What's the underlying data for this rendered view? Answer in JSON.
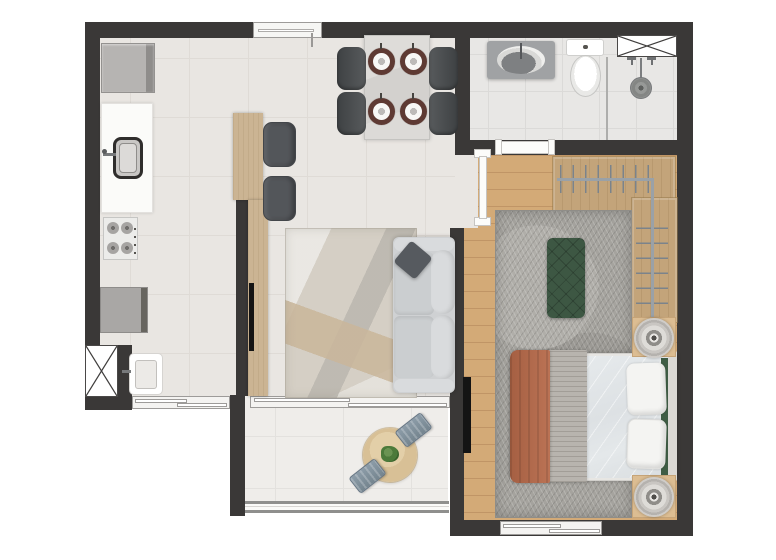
{
  "meta": {
    "type": "apartment-floor-plan",
    "view": "top-down-3d-render",
    "canvas_width": 776,
    "canvas_height": 560,
    "visible_text": "none"
  },
  "colors": {
    "wall": "#3a3837",
    "floor-main": "#e9e6e2",
    "tile-line": "#dfdbd6",
    "floor-bath": "#e8e7e5",
    "floor-balcony": "#efedea",
    "wood-floor": "#d3aa77",
    "plank-line": "#c09566",
    "wood-closet": "#c3a47a",
    "wood-island": "#cbb493",
    "rug-living": "#d5cfc5",
    "rug-bedroom": "#a5a39e",
    "sofa": "#cfd1d3",
    "sofa-light": "#d9dbdd",
    "pillow-dark": "#565a5f",
    "chair-dark": "#4b4e50",
    "stool": "#53565a",
    "table-marble": "#dad8d5",
    "charger": "#5e3a33",
    "bench-green": "#3d5743",
    "duvet": "#dfe3e6",
    "blanket": "#b2694c",
    "throw": "#b8b4ae",
    "headboard-green": "#3f5d45",
    "nightstand": "#dcbd92",
    "counter-white": "#fbfbf9",
    "appliance": "#b0aeac",
    "washer": "#a9a7a5",
    "vanity": "#a0a2a4",
    "fixture-white": "#f8f8f6",
    "drain": "#8a8c8e",
    "rod": "#9aa1a7",
    "hanger": "#7b838b",
    "balcony-table": "#d8c096",
    "balcony-chair": "#7f8f9b",
    "plant": "#4c7a3a",
    "railing": "#8f8f8d",
    "window-white": "#f4f3f1",
    "tv": "#141414",
    "door-white": "#fcfcfa"
  },
  "rooms": [
    {
      "id": "kitchen",
      "items": [
        "refrigerator",
        "counter-with-sink",
        "cooktop-4-burners",
        "island-counter",
        "bar-stool",
        "bar-stool"
      ]
    },
    {
      "id": "service-area",
      "items": [
        "washing-machine",
        "laundry-tank",
        "ventilation-shaft",
        "window"
      ]
    },
    {
      "id": "dining",
      "items": [
        "dining-table",
        "place-setting-x4",
        "dining-chair-x4"
      ]
    },
    {
      "id": "living",
      "items": [
        "two-seat-sofa",
        "throw-pillow",
        "abstract-rug",
        "tv-on-island"
      ]
    },
    {
      "id": "balcony",
      "items": [
        "round-table",
        "plant",
        "chair-x2",
        "glass-railing",
        "sliding-door"
      ]
    },
    {
      "id": "bathroom",
      "items": [
        "vanity-oval-sink",
        "toilet",
        "shower-drain",
        "shower-knob-x2",
        "glass-partition",
        "ventilation-shaft"
      ]
    },
    {
      "id": "bedroom",
      "items": [
        "double-bed",
        "pillow-x2",
        "terracotta-blanket",
        "knit-throw",
        "green-tufted-bench",
        "gray-rug",
        "open-closet-hangers",
        "nightstand-lamp-x2",
        "wall-tv",
        "window"
      ]
    }
  ],
  "openings": [
    "entry-door-top",
    "bedroom-door",
    "bathroom-door",
    "balcony-sliding-door",
    "service-window",
    "bedroom-window"
  ]
}
